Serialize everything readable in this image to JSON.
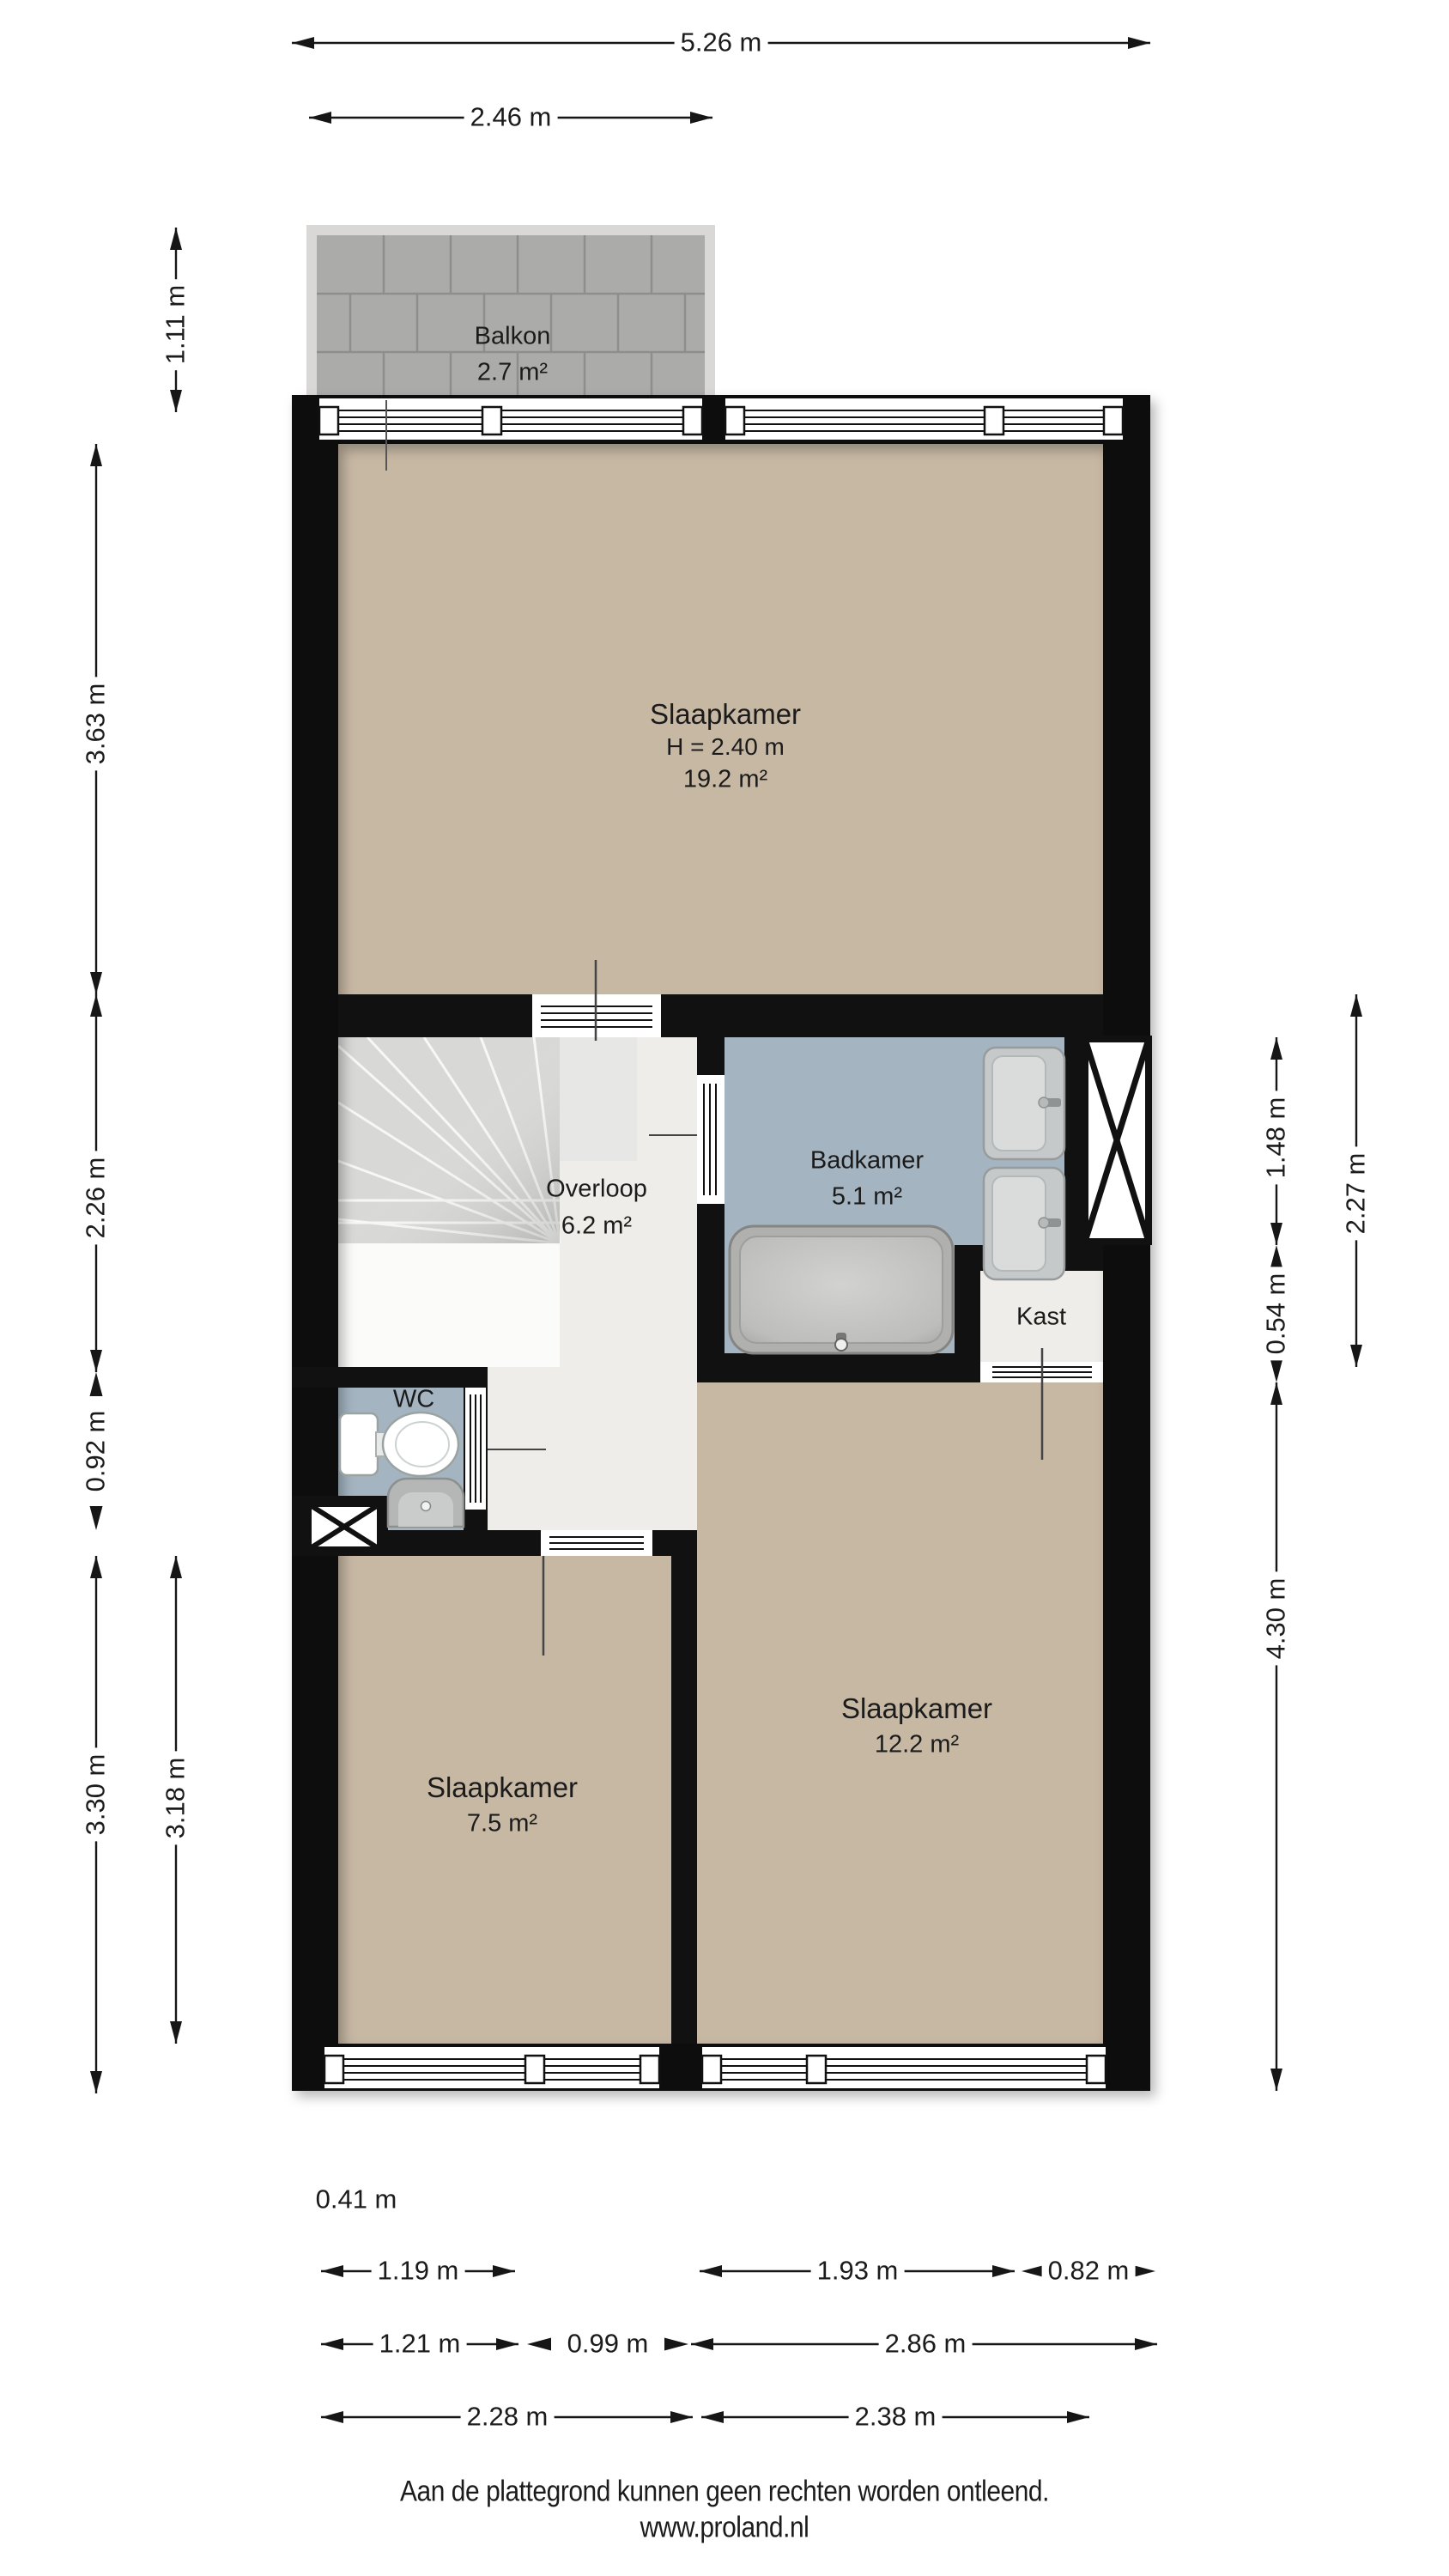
{
  "title": "Floor plan (plattegrond) - verdieping",
  "rooms": {
    "balkon": {
      "name": "Balkon",
      "area": "2.7 m²"
    },
    "slaapkamer1": {
      "name": "Slaapkamer",
      "ceiling": "H = 2.40 m",
      "area": "19.2 m²"
    },
    "overloop": {
      "name": "Overloop",
      "area": "6.2 m²"
    },
    "badkamer": {
      "name": "Badkamer",
      "area": "5.1 m²"
    },
    "kast": {
      "name": "Kast"
    },
    "wc": {
      "name": "WC"
    },
    "slaapkamer2": {
      "name": "Slaapkamer",
      "area": "7.5 m²"
    },
    "slaapkamer3": {
      "name": "Slaapkamer",
      "area": "12.2 m²"
    }
  },
  "dims": {
    "w_total": "5.26 m",
    "w_balkon": "2.46 m",
    "d_balkon": "1.11 m",
    "h_sk1": "3.63 m",
    "h_mid": "2.26 m",
    "h_wc": "0.92 m",
    "h_sk2": "3.30 m",
    "h_sk2_in": "3.18 m",
    "h_bad": "1.48 m",
    "h_badkast": "2.27 m",
    "h_kast": "0.54 m",
    "h_sk3": "4.30 m",
    "off_left": "0.41 m",
    "w_sk2win": "1.19 m",
    "w_sk3win": "1.93 m",
    "w_sk3win_r": "0.82 m",
    "w_b1": "1.21 m",
    "w_b2": "0.99 m",
    "w_b3": "2.86 m",
    "w_sk2": "2.28 m",
    "w_sk3": "2.38 m"
  },
  "footer": {
    "line1": "Aan de plattegrond kunnen geen rechten worden ontleend.",
    "line2": "www.proland.nl"
  },
  "fixtures": [
    "bathtub-icon",
    "sink-icon",
    "sink-icon",
    "toilet-icon",
    "fountain-sink-icon",
    "stairs-icon",
    "shaft-x-icon",
    "shaft-x-icon"
  ],
  "colors": {
    "wall": "#111111",
    "floor_bedroom": "#c7b8a4",
    "floor_bathroom": "#a4b5c1",
    "floor_hall": "#eeede9",
    "balcony_tile": "#ababa9",
    "balcony_grout": "#8e8e8c",
    "railing": "#d9d8d6",
    "stairs": "#d8d8d6",
    "dimension_line": "#161616"
  }
}
